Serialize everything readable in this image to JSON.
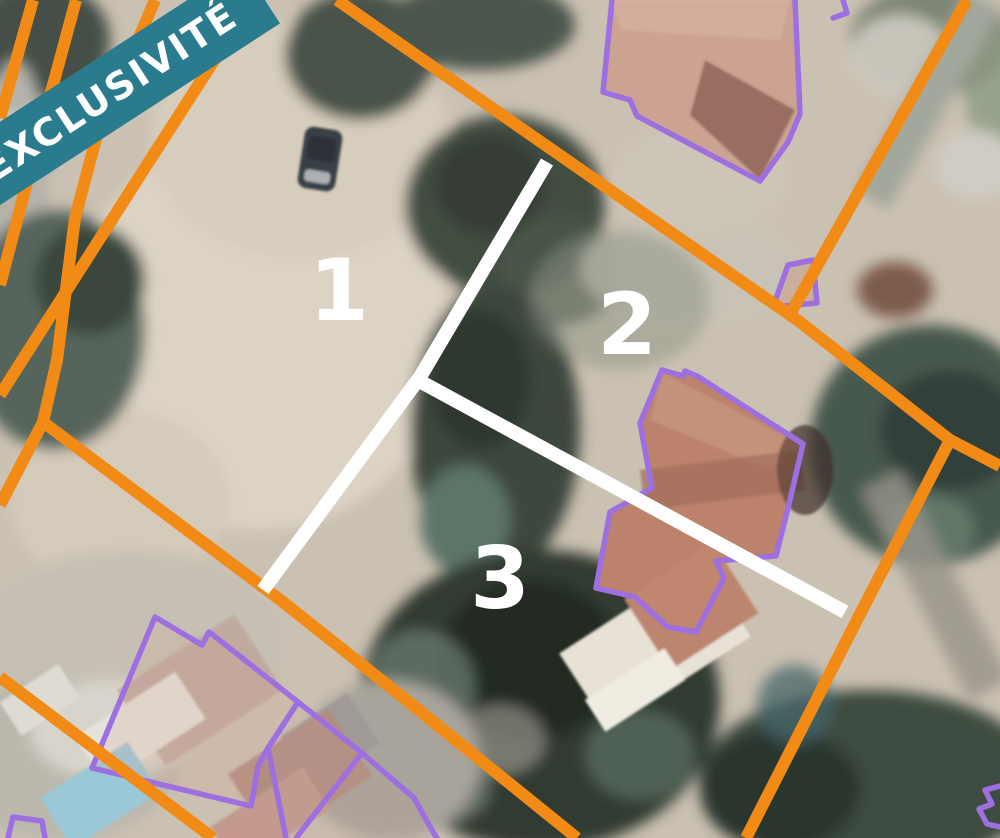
{
  "banner": {
    "label": "EXCLUSIVITÉ"
  },
  "lot_labels": {
    "lot1": "1",
    "lot2": "2",
    "lot3": "3"
  },
  "colors": {
    "banner_background": "#2a7b8d",
    "banner_text": "#ffffff",
    "parcel_boundary_orange": "#f28b16",
    "building_outline_purple": "#9e6fe0",
    "lot_divider_white": "#ffffff",
    "lot_label_white": "#ffffff"
  }
}
